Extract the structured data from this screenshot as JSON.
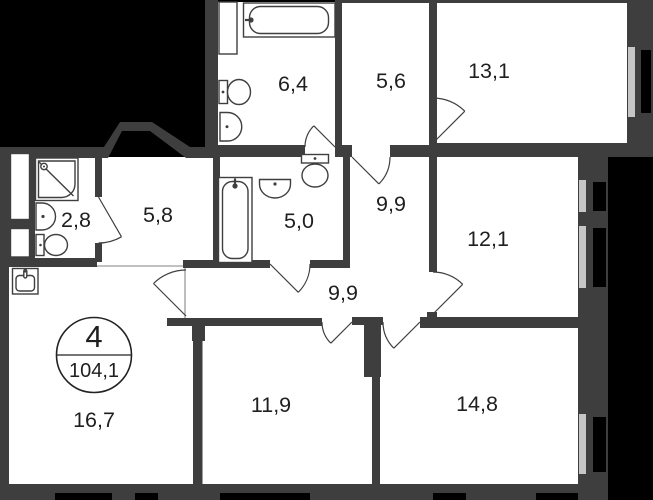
{
  "apartment": {
    "rooms_count": "4",
    "total_area": "104,1"
  },
  "plan": {
    "rooms": [
      {
        "id": "bathroom-top",
        "area": "6,4"
      },
      {
        "id": "hallway-top",
        "area": "5,6"
      },
      {
        "id": "room-right-top",
        "area": "13,1"
      },
      {
        "id": "wc-left",
        "area": "2,8"
      },
      {
        "id": "hallway-left",
        "area": "5,8"
      },
      {
        "id": "bathroom-mid",
        "area": "5,0"
      },
      {
        "id": "corridor-upper",
        "area": "9,9"
      },
      {
        "id": "room-right-mid",
        "area": "12,1"
      },
      {
        "id": "corridor-lower",
        "area": "9,9"
      },
      {
        "id": "kitchen-living",
        "area": "16,7"
      },
      {
        "id": "room-bottom-mid",
        "area": "11,9"
      },
      {
        "id": "room-bottom-right",
        "area": "14,8"
      }
    ]
  },
  "colors": {
    "background": "#000000",
    "wall": "#3e3e3e",
    "floor": "#ffffff",
    "window": "#c6c6c6",
    "label": "#1f1f1f"
  }
}
